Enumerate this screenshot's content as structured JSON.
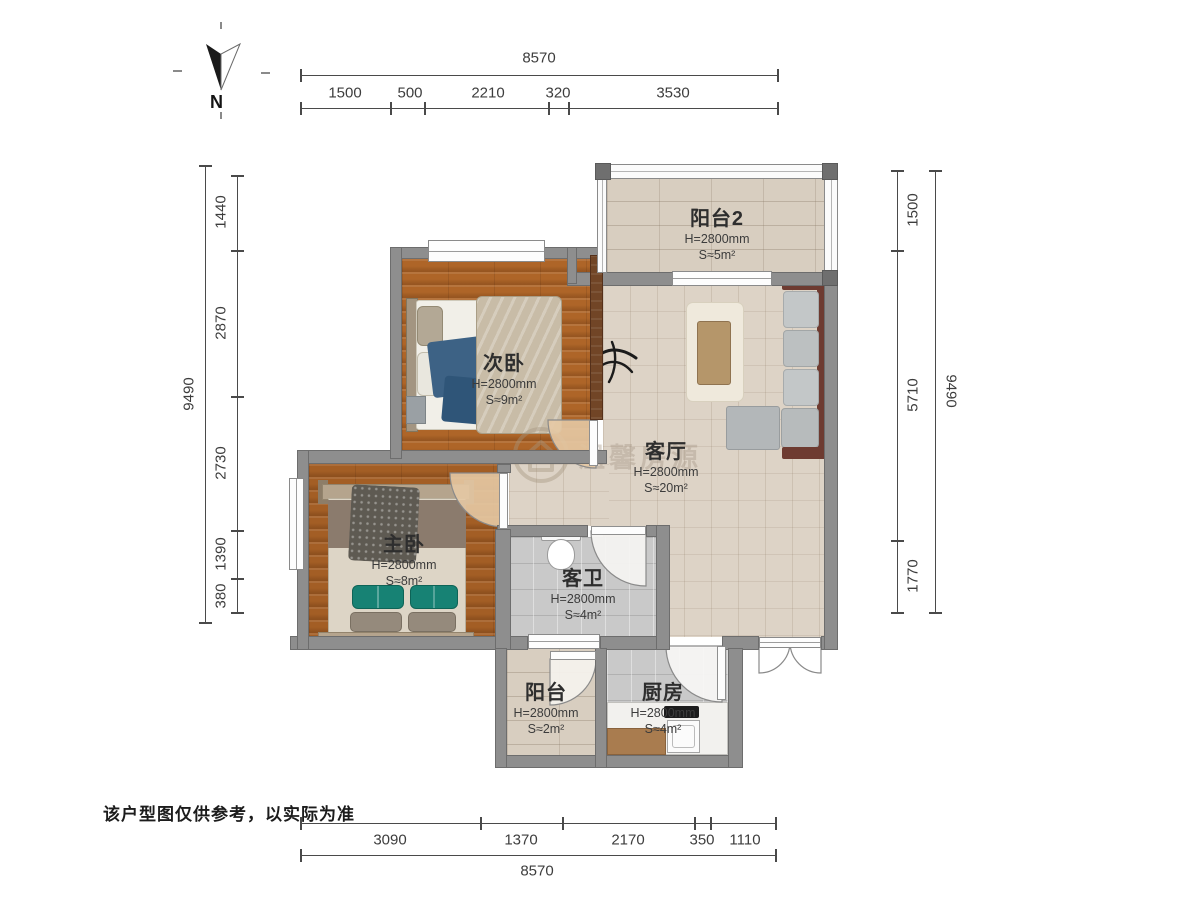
{
  "meta": {
    "type": "apartment-floorplan",
    "background": "#ffffff"
  },
  "north": {
    "label": "N"
  },
  "disclaimer": "该户型图仅供参考，以实际为准",
  "watermark": {
    "icon": "house-circle-icon",
    "text": "温馨房源"
  },
  "rooms": [
    {
      "id": "balcony2",
      "name": "阳台2",
      "height": "H=2800mm",
      "area": "S≈5m²"
    },
    {
      "id": "second-bedroom",
      "name": "次卧",
      "height": "H=2800mm",
      "area": "S≈9m²"
    },
    {
      "id": "living-room",
      "name": "客厅",
      "height": "H=2800mm",
      "area": "S≈20m²"
    },
    {
      "id": "master-bedroom",
      "name": "主卧",
      "height": "H=2800mm",
      "area": "S≈8m²"
    },
    {
      "id": "bathroom",
      "name": "客卫",
      "height": "H=2800mm",
      "area": "S≈4m²"
    },
    {
      "id": "balcony",
      "name": "阳台",
      "height": "H=2800mm",
      "area": "S≈2m²"
    },
    {
      "id": "kitchen",
      "name": "厨房",
      "height": "H=2800mm",
      "area": "S≈4m²"
    }
  ],
  "dimensions": {
    "top": {
      "total": "8570",
      "segments": [
        "1500",
        "500",
        "2210",
        "320",
        "3530"
      ]
    },
    "bottom": {
      "total": "8570",
      "segments": [
        "3090",
        "1370",
        "2170",
        "350",
        "1110"
      ]
    },
    "left": {
      "total": "9490",
      "segments": [
        "1440",
        "2870",
        "2730",
        "1390",
        "380"
      ]
    },
    "right": {
      "total": "9490",
      "segments": [
        "1500",
        "5710",
        "1770"
      ]
    }
  },
  "colors": {
    "wall": "#8e8e8e",
    "wood_wall": "#714526",
    "wood_floor": "#ae6528",
    "living_floor": "#ddd3c6",
    "tile_beige": "#d8cec0",
    "tile_gray": "#c9c9c9",
    "sofa_frame": "#6e3b31",
    "sofa_cushion": "#c0c4c5",
    "table": "#b5966a",
    "green_pillow": "#178274",
    "blue_blanket": "#3d6285",
    "dim_line": "#4a4a4a"
  }
}
